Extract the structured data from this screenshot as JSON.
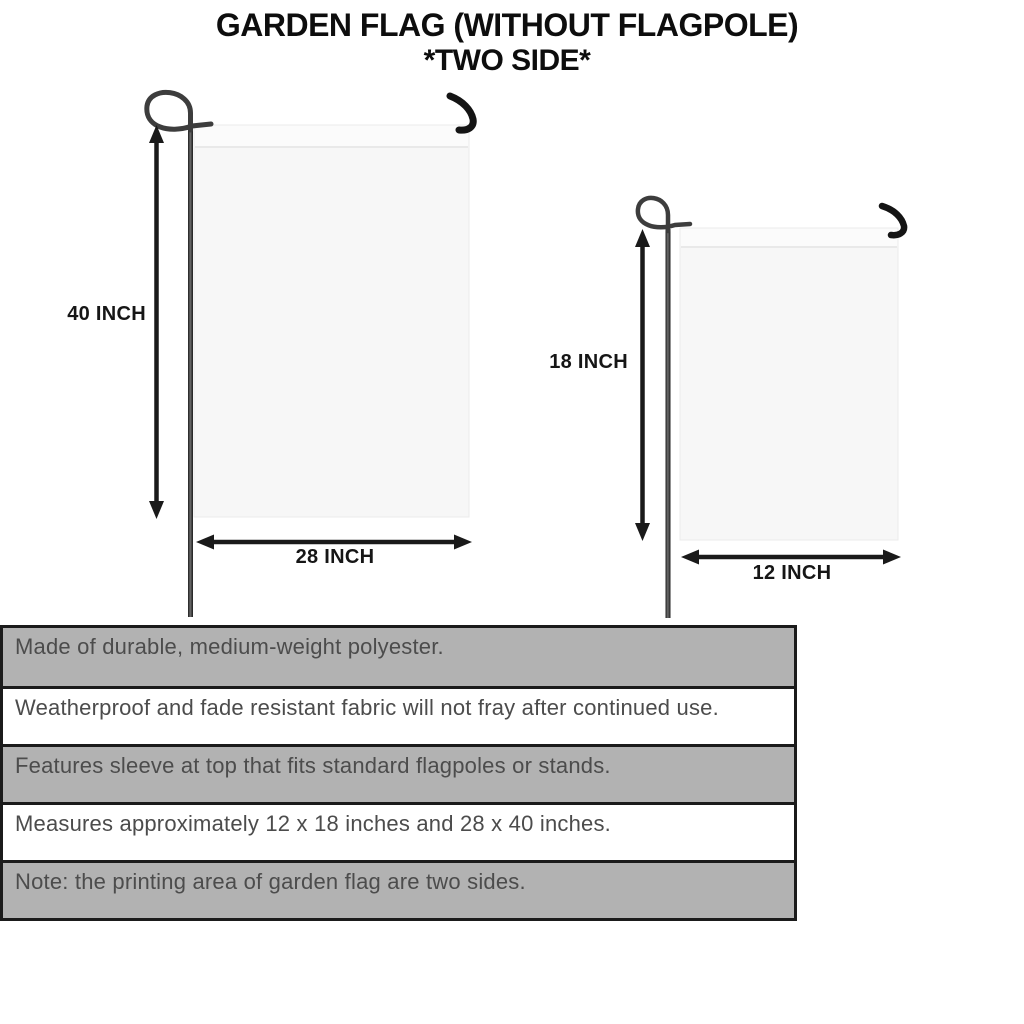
{
  "title": {
    "line1": "GARDEN FLAG (WITHOUT FLAGPOLE)",
    "line2": "*TWO SIDE*"
  },
  "flags": {
    "large": {
      "name": "large garden flag 28 x 40 inches",
      "height_label": "40 INCH",
      "width_label": "28 INCH"
    },
    "small": {
      "name": "small garden flag 12 x 18 inches",
      "height_label": "18 INCH",
      "width_label": "12 INCH"
    }
  },
  "features": {
    "rows": [
      {
        "text": "Made of durable, medium-weight polyester.",
        "shaded": true
      },
      {
        "text": "Weatherproof and fade resistant fabric will not fray after continued use.",
        "shaded": false
      },
      {
        "text": "Features sleeve at top that fits standard flagpoles or stands.",
        "shaded": true
      },
      {
        "text": "Measures approximately 12 x 18 inches and 28 x 40 inches.",
        "shaded": false
      },
      {
        "text": "Note: the printing area of garden flag are two sides.",
        "shaded": true
      }
    ]
  },
  "icons": {
    "pole_loop": "curled-wire-loop",
    "hanger_hook": "bent-wire-hook",
    "dimension_arrow": "double-headed-arrow"
  },
  "colors": {
    "title_black": "#0d0d0d",
    "line_black": "#1a1a1a",
    "pole_dark": "#3d3d3d",
    "row_gray": "#b2b2b2",
    "flag_fill": "#f7f7f7",
    "row_text": "#4c4c4c"
  }
}
